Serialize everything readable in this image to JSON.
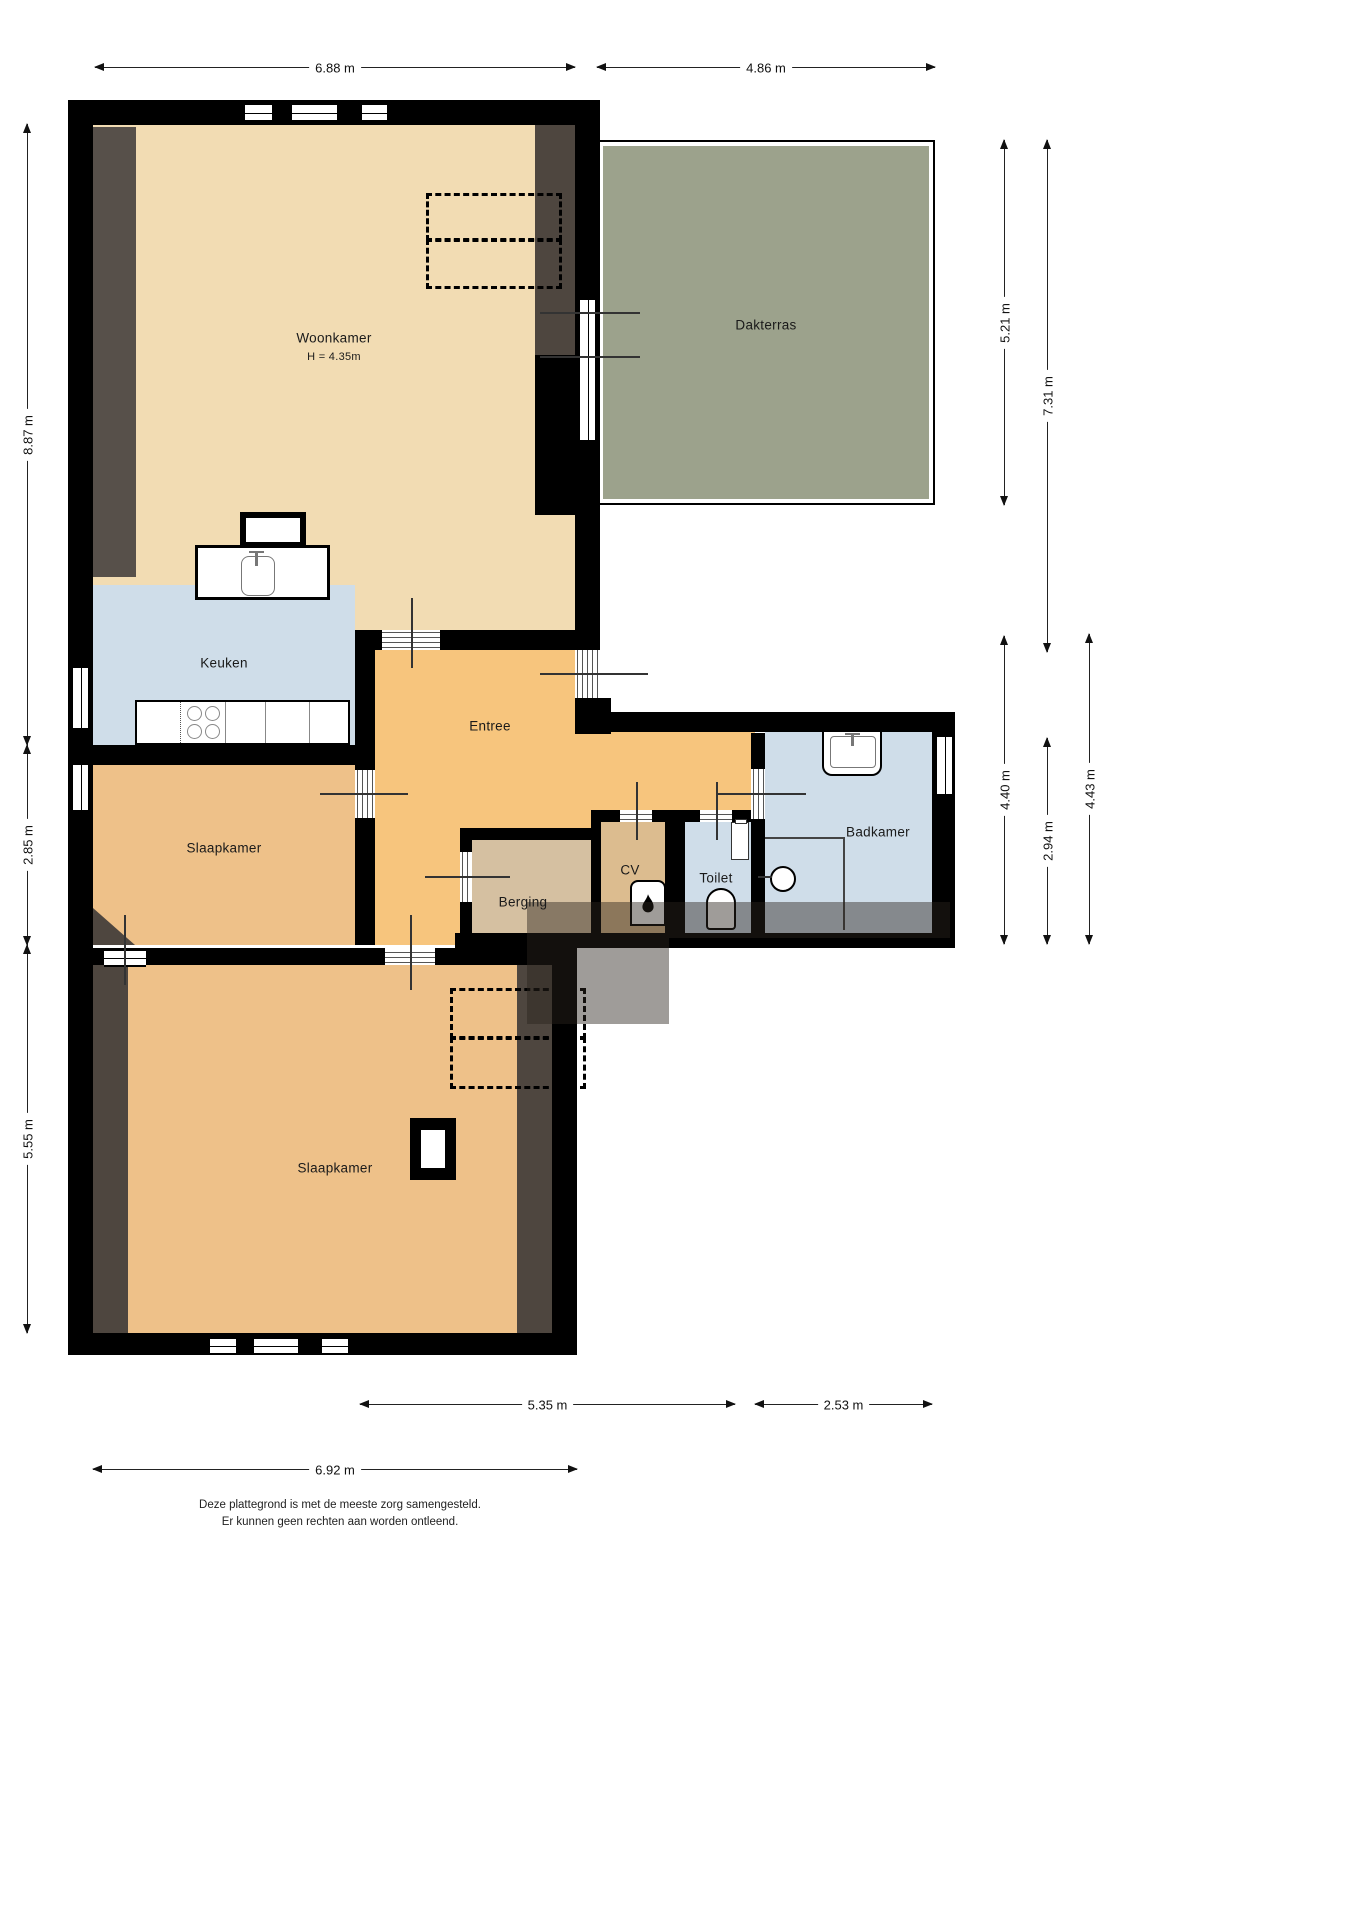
{
  "plan": {
    "rooms": {
      "woonkamer": "Woonkamer",
      "woonkamer_height": "H = 4.35m",
      "dakterras": "Dakterras",
      "keuken": "Keuken",
      "entree": "Entree",
      "slaapkamer_mid": "Slaapkamer",
      "berging": "Berging",
      "cv": "CV",
      "toilet": "Toilet",
      "badkamer": "Badkamer",
      "slaapkamer_bottom": "Slaapkamer"
    },
    "dimensions": {
      "top_width_left": "6.88 m",
      "top_width_right": "4.86 m",
      "left_top": "8.87 m",
      "left_middle": "2.85 m",
      "left_bottom": "5.55 m",
      "right_terrace": "5.21 m",
      "right_terrace_total": "7.31 m",
      "right_mid_inner": "4.40 m",
      "right_mid_bath": "2.94 m",
      "right_mid_outer": "4.43 m",
      "bottom_mid": "5.35 m",
      "bottom_right": "2.53 m",
      "bottom_left": "6.92 m"
    },
    "footer": {
      "line1": "Deze plattegrond is met de meeste zorg samengesteld.",
      "line2": "Er kunnen geen rechten aan worden ontleend."
    },
    "colors": {
      "wall": "#000000",
      "woonkamer_fill": "#f2dcb3",
      "kitchen_bath_fill": "#cfdde9",
      "entree_fill": "#f7c57d",
      "slaapkamer_fill": "#eec189",
      "berging_fill": "#d5c0a1",
      "cv_fill": "#dcbc8f",
      "dakterras_fill": "#9ca28c",
      "sloped_zone": "#4e463f"
    }
  }
}
